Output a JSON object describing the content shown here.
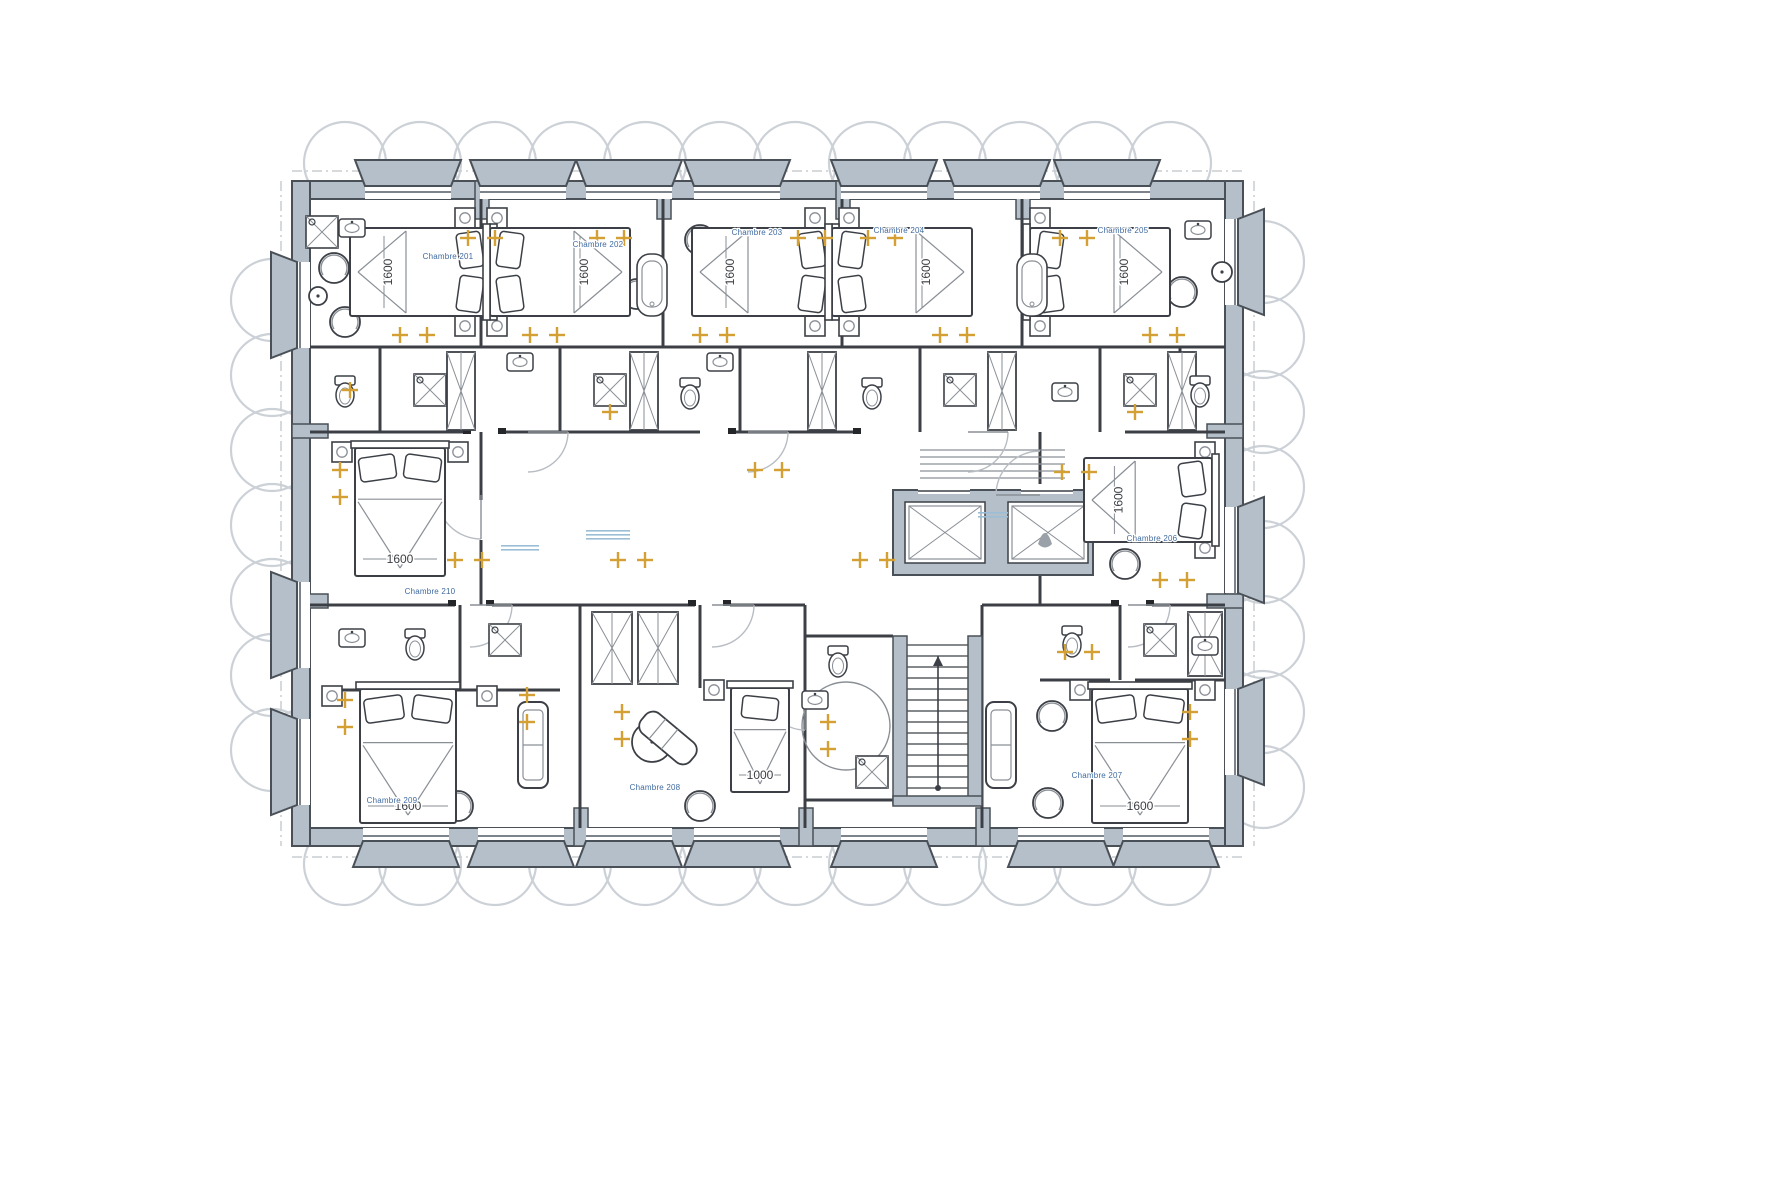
{
  "drawing": {
    "kind": "hotel-guestroom-floor-plan",
    "language": "French"
  },
  "colors": {
    "wall_fill": "#b5bfc9",
    "wall_stroke": "#4a5057",
    "line": "#3c4046",
    "line_light": "#8a8f96",
    "glazing": "#7d838a",
    "light_amber": "#d4a033",
    "room_label": "#3f6aa0",
    "dim_text": "#3a3d42",
    "facade_circle": "#ccd1d7",
    "annotation": "#9bbdd6",
    "arc": "#b8bdc3",
    "dash": "#c8cdd2",
    "jamb": "#24262a",
    "white": "#ffffff"
  },
  "plan": {
    "x": 292,
    "y": 181,
    "w": 951,
    "h": 665,
    "wall": 18
  },
  "piers": [
    [
      475,
      181,
      14,
      38
    ],
    [
      657,
      181,
      14,
      38
    ],
    [
      836,
      181,
      14,
      38
    ],
    [
      1016,
      181,
      14,
      38
    ],
    [
      574,
      808,
      14,
      38
    ],
    [
      799,
      808,
      14,
      38
    ],
    [
      976,
      808,
      14,
      38
    ],
    [
      292,
      424,
      36,
      14
    ],
    [
      292,
      594,
      36,
      14
    ],
    [
      1207,
      424,
      36,
      14
    ],
    [
      1207,
      594,
      36,
      14
    ]
  ],
  "window_bays": {
    "top": [
      408,
      523,
      629,
      737,
      884,
      997,
      1107
    ],
    "bottom": [
      406,
      521,
      629,
      737,
      884,
      1061,
      1166
    ],
    "left": [
      305,
      625,
      762
    ],
    "right": [
      262,
      550,
      732
    ],
    "half_w": 43,
    "half_w_out": 53
  },
  "facade_circles": {
    "r": 41,
    "top_y": 163,
    "bottom_y": 864,
    "left_x": 272,
    "right_x": 1263,
    "top_xs": [
      345,
      420,
      495,
      570,
      645,
      720,
      795,
      870,
      945,
      1020,
      1095,
      1170
    ],
    "left_ys": [
      300,
      375,
      450,
      525,
      600,
      675,
      750
    ],
    "right_ys": [
      262,
      337,
      412,
      487,
      562,
      637,
      712,
      787
    ]
  },
  "dash_lines": [
    [
      292,
      171,
      1243,
      171
    ],
    [
      292,
      857,
      1243,
      857
    ],
    [
      281,
      181,
      281,
      846
    ],
    [
      1254,
      181,
      1254,
      846
    ]
  ],
  "interior_walls": [
    [
      481,
      199,
      481,
      347
    ],
    [
      663,
      199,
      663,
      347
    ],
    [
      842,
      199,
      842,
      347
    ],
    [
      1022,
      199,
      1022,
      347
    ],
    [
      310,
      347,
      1225,
      347
    ],
    [
      380,
      347,
      380,
      432
    ],
    [
      560,
      347,
      560,
      432
    ],
    [
      740,
      347,
      740,
      432
    ],
    [
      920,
      347,
      920,
      432
    ],
    [
      1100,
      347,
      1100,
      432
    ],
    [
      1180,
      347,
      1180,
      432
    ],
    [
      310,
      432,
      470,
      432
    ],
    [
      505,
      432,
      700,
      432
    ],
    [
      735,
      432,
      860,
      432
    ],
    [
      1125,
      432,
      1225,
      432
    ],
    [
      481,
      432,
      481,
      500
    ],
    [
      481,
      540,
      481,
      605
    ],
    [
      1040,
      432,
      1040,
      500
    ],
    [
      1040,
      540,
      1040,
      605
    ],
    [
      310,
      605,
      455,
      605
    ],
    [
      492,
      605,
      695,
      605
    ],
    [
      730,
      605,
      805,
      605
    ],
    [
      982,
      605,
      1118,
      605
    ],
    [
      1152,
      605,
      1225,
      605
    ],
    [
      580,
      605,
      580,
      828
    ],
    [
      805,
      605,
      805,
      828
    ],
    [
      982,
      605,
      982,
      828
    ],
    [
      460,
      605,
      460,
      690
    ],
    [
      330,
      690,
      560,
      690
    ],
    [
      700,
      605,
      700,
      688
    ],
    [
      1120,
      605,
      1120,
      680
    ],
    [
      1040,
      680,
      1110,
      680
    ],
    [
      1135,
      680,
      1225,
      680
    ],
    [
      805,
      636,
      893,
      636
    ],
    [
      805,
      800,
      982,
      800
    ]
  ],
  "jambs": [
    [
      452,
      600
    ],
    [
      490,
      600
    ],
    [
      692,
      600
    ],
    [
      727,
      600
    ],
    [
      1115,
      600
    ],
    [
      1150,
      600
    ],
    [
      467,
      428
    ],
    [
      502,
      428
    ],
    [
      732,
      428
    ],
    [
      857,
      428
    ]
  ],
  "core": {
    "x": 893,
    "y": 490,
    "w": 200,
    "h": 85,
    "shafts": [
      [
        905,
        502,
        80,
        61
      ],
      [
        1008,
        502,
        80,
        61
      ]
    ],
    "cars": [
      [
        909,
        506,
        72,
        53
      ],
      [
        1012,
        506,
        72,
        53
      ]
    ],
    "doors": [
      [
        918,
        484,
        52,
        10
      ],
      [
        1021,
        484,
        52,
        10
      ]
    ],
    "mat": {
      "x1": 920,
      "x2": 1065,
      "ys": [
        450,
        457,
        464,
        471,
        478
      ]
    }
  },
  "stair": {
    "tx1": 907,
    "tx2": 968,
    "y1": 645,
    "y2": 795,
    "step": 11,
    "walls": [
      [
        893,
        636,
        14,
        168
      ],
      [
        968,
        636,
        14,
        168
      ],
      [
        893,
        796,
        89,
        10
      ]
    ],
    "arrow": {
      "x": 938,
      "y1": 788,
      "y2": 656
    }
  },
  "access_bath_circle": [
    846,
    726,
    44
  ],
  "door_arcs": [
    [
      481,
      495,
      44,
      90
    ],
    [
      1040,
      495,
      44,
      180
    ],
    [
      528,
      432,
      40,
      0
    ],
    [
      748,
      432,
      40,
      0
    ],
    [
      968,
      432,
      40,
      0
    ],
    [
      470,
      605,
      42,
      0
    ],
    [
      712,
      605,
      42,
      0
    ],
    [
      1128,
      605,
      42,
      0
    ],
    [
      805,
      692,
      38,
      90
    ]
  ],
  "rooms": [
    {
      "number": "201",
      "label": "Chambre 201",
      "x": 448,
      "y": 259
    },
    {
      "number": "202",
      "label": "Chambre 202",
      "x": 598,
      "y": 247
    },
    {
      "number": "203",
      "label": "Chambre 203",
      "x": 757,
      "y": 235
    },
    {
      "number": "204",
      "label": "Chambre 204",
      "x": 899,
      "y": 233
    },
    {
      "number": "205",
      "label": "Chambre 205",
      "x": 1123,
      "y": 233
    },
    {
      "number": "206",
      "label": "Chambre 206",
      "x": 1152,
      "y": 541
    },
    {
      "number": "207",
      "label": "Chambre 207",
      "x": 1097,
      "y": 778
    },
    {
      "number": "208",
      "label": "Chambre 208",
      "x": 655,
      "y": 790
    },
    {
      "number": "209",
      "label": "Chambre 209",
      "x": 392,
      "y": 803
    },
    {
      "number": "210",
      "label": "Chambre 210",
      "x": 430,
      "y": 594
    }
  ],
  "beds": [
    {
      "cx": 420,
      "cy": 272,
      "w": 140,
      "h": 88,
      "o": "h",
      "p": "right",
      "dim": "1600"
    },
    {
      "cx": 560,
      "cy": 272,
      "w": 140,
      "h": 88,
      "o": "h",
      "p": "left",
      "dim": "1600"
    },
    {
      "cx": 762,
      "cy": 272,
      "w": 140,
      "h": 88,
      "o": "h",
      "p": "right",
      "dim": "1600"
    },
    {
      "cx": 902,
      "cy": 272,
      "w": 140,
      "h": 88,
      "o": "h",
      "p": "left",
      "dim": "1600"
    },
    {
      "cx": 1100,
      "cy": 272,
      "w": 140,
      "h": 88,
      "o": "h",
      "p": "left",
      "dim": "1600"
    },
    {
      "cx": 1148,
      "cy": 500,
      "w": 128,
      "h": 84,
      "o": "h",
      "p": "right",
      "dim": "1600"
    },
    {
      "cx": 400,
      "cy": 512,
      "w": 90,
      "h": 128,
      "o": "v",
      "p": "top",
      "dim": "1600"
    },
    {
      "cx": 408,
      "cy": 756,
      "w": 96,
      "h": 134,
      "o": "v",
      "p": "top",
      "dim": "1600"
    },
    {
      "cx": 760,
      "cy": 740,
      "w": 58,
      "h": 104,
      "o": "v",
      "p": "top",
      "dim": "1000"
    },
    {
      "cx": 1140,
      "cy": 756,
      "w": 96,
      "h": 134,
      "o": "v",
      "p": "top",
      "dim": "1600"
    }
  ],
  "nightstands": [
    [
      465,
      218
    ],
    [
      465,
      326
    ],
    [
      497,
      218
    ],
    [
      497,
      326
    ],
    [
      815,
      218
    ],
    [
      815,
      326
    ],
    [
      849,
      218
    ],
    [
      849,
      326
    ],
    [
      1040,
      218
    ],
    [
      1040,
      326
    ],
    [
      342,
      452
    ],
    [
      458,
      452
    ],
    [
      1205,
      452
    ],
    [
      1205,
      548
    ],
    [
      332,
      696
    ],
    [
      487,
      696
    ],
    [
      714,
      690
    ],
    [
      1080,
      690
    ],
    [
      1205,
      690
    ]
  ],
  "sofas": [
    [
      518,
      702,
      30,
      86
    ],
    [
      986,
      702,
      30,
      86
    ]
  ],
  "armchairs": [
    [
      334,
      268
    ],
    [
      345,
      322
    ],
    [
      637,
      294
    ],
    [
      700,
      240
    ],
    [
      1182,
      292
    ],
    [
      1125,
      564
    ],
    [
      458,
      806
    ],
    [
      700,
      806
    ],
    [
      1052,
      716
    ],
    [
      1048,
      803
    ]
  ],
  "tables": [
    [
      318,
      296,
      9
    ],
    [
      652,
      742,
      20
    ],
    [
      1222,
      272,
      10
    ]
  ],
  "chaises": [
    [
      668,
      738,
      40
    ]
  ],
  "wardrobes": [
    [
      447,
      352,
      28,
      78
    ],
    [
      630,
      352,
      28,
      78
    ],
    [
      808,
      352,
      28,
      78
    ],
    [
      988,
      352,
      28,
      78
    ],
    [
      1168,
      352,
      28,
      78
    ],
    [
      592,
      612,
      40,
      72
    ],
    [
      638,
      612,
      40,
      72
    ],
    [
      1188,
      612,
      34,
      64
    ]
  ],
  "fixtures": {
    "toilets": [
      [
        345,
        392
      ],
      [
        690,
        394
      ],
      [
        872,
        394
      ],
      [
        1200,
        392
      ],
      [
        415,
        645
      ],
      [
        1072,
        642
      ],
      [
        838,
        662
      ]
    ],
    "showers": [
      [
        430,
        390
      ],
      [
        610,
        390
      ],
      [
        960,
        390
      ],
      [
        1140,
        390
      ],
      [
        322,
        232
      ],
      [
        505,
        640
      ],
      [
        1160,
        640
      ],
      [
        872,
        772
      ]
    ],
    "sinks": [
      [
        352,
        228
      ],
      [
        1198,
        230
      ],
      [
        520,
        362
      ],
      [
        720,
        362
      ],
      [
        1065,
        392
      ],
      [
        352,
        638
      ],
      [
        1205,
        646
      ],
      [
        815,
        700
      ]
    ],
    "tubs": [
      [
        652,
        285
      ],
      [
        1032,
        285
      ]
    ]
  },
  "lights": [
    [
      468,
      238
    ],
    [
      495,
      238
    ],
    [
      400,
      335
    ],
    [
      427,
      335
    ],
    [
      597,
      238
    ],
    [
      624,
      238
    ],
    [
      530,
      335
    ],
    [
      557,
      335
    ],
    [
      798,
      238
    ],
    [
      825,
      238
    ],
    [
      700,
      335
    ],
    [
      727,
      335
    ],
    [
      868,
      238
    ],
    [
      895,
      238
    ],
    [
      940,
      335
    ],
    [
      967,
      335
    ],
    [
      1060,
      238
    ],
    [
      1087,
      238
    ],
    [
      1150,
      335
    ],
    [
      1177,
      335
    ],
    [
      340,
      470
    ],
    [
      340,
      497
    ],
    [
      455,
      560
    ],
    [
      482,
      560
    ],
    [
      1062,
      472
    ],
    [
      1089,
      472
    ],
    [
      1160,
      580
    ],
    [
      1187,
      580
    ],
    [
      345,
      700
    ],
    [
      345,
      727
    ],
    [
      527,
      695
    ],
    [
      527,
      722
    ],
    [
      622,
      712
    ],
    [
      622,
      739
    ],
    [
      1190,
      712
    ],
    [
      1190,
      739
    ],
    [
      1065,
      652
    ],
    [
      1092,
      652
    ],
    [
      828,
      722
    ],
    [
      828,
      749
    ],
    [
      618,
      560
    ],
    [
      645,
      560
    ],
    [
      860,
      560
    ],
    [
      887,
      560
    ],
    [
      755,
      470
    ],
    [
      782,
      470
    ],
    [
      350,
      390
    ],
    [
      610,
      412
    ],
    [
      1135,
      412
    ]
  ],
  "annotations": [
    [
      520,
      545,
      2,
      38
    ],
    [
      608,
      530,
      3,
      44
    ],
    [
      993,
      512,
      2,
      30
    ]
  ]
}
